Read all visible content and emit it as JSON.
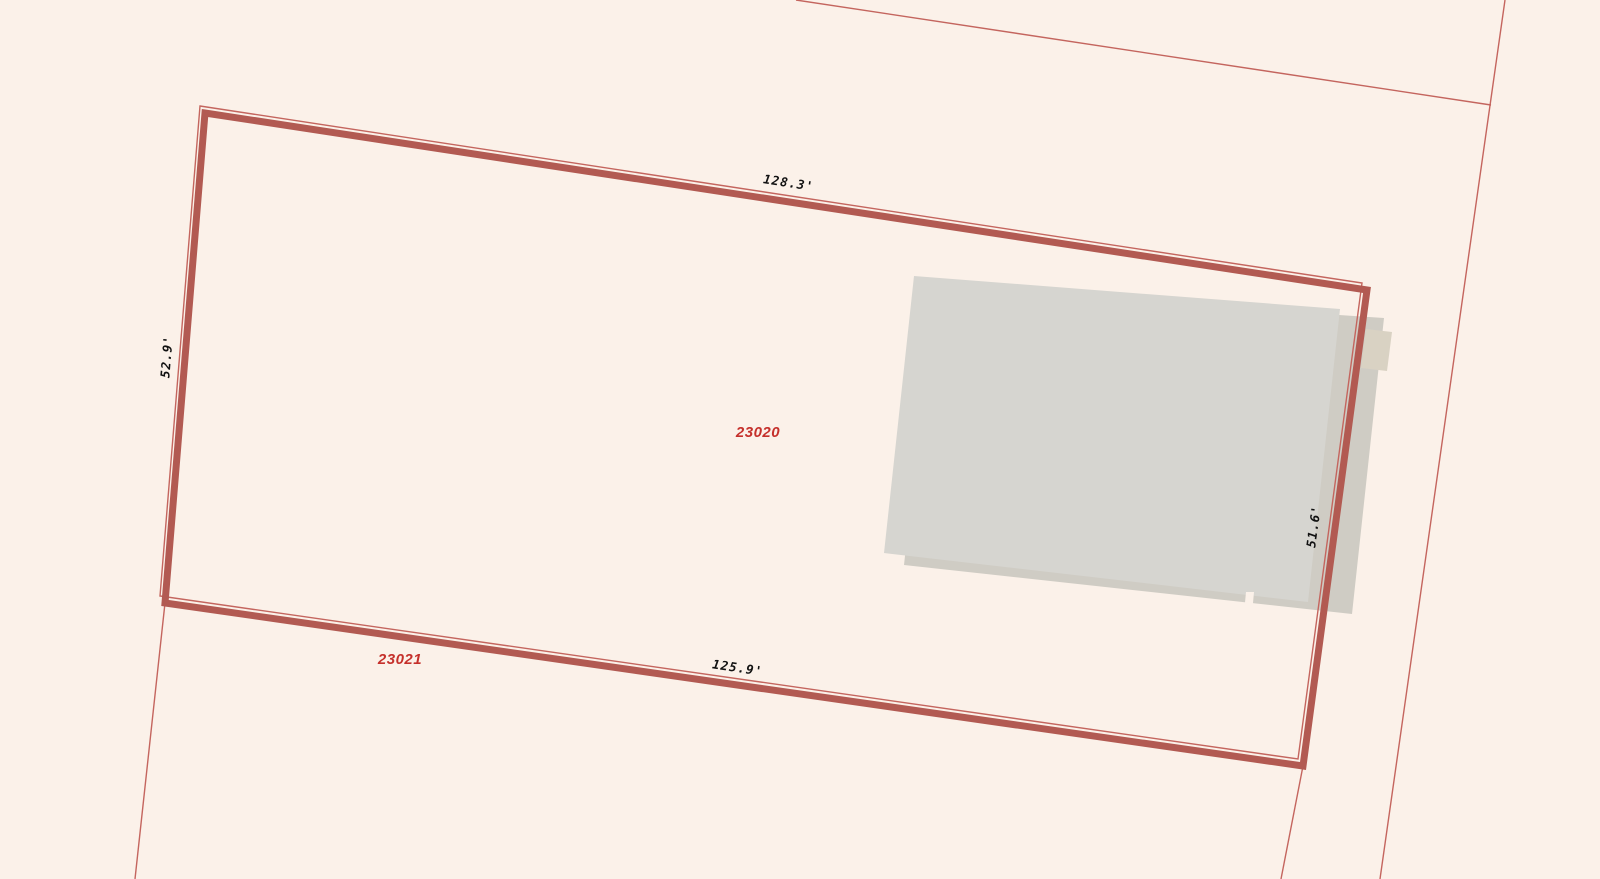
{
  "map": {
    "colors": {
      "background": "#fbf1e9",
      "selected_parcel_outline": "#b25a52",
      "boundary_line": "#c4655e",
      "building_fill": "#d6d5d0",
      "building_shadow_fill": "#cfccc4",
      "building_annex_fill": "#d9d2c3",
      "dimension_text": "#111111",
      "parcel_id_text": "#c5302b"
    },
    "selected_parcel": {
      "id": "23020",
      "dim_top": "128.3'",
      "dim_left": "52.9'",
      "dim_bottom": "125.9'",
      "dim_right": "51.6'"
    },
    "adjacent_parcel": {
      "id": "23021"
    }
  }
}
